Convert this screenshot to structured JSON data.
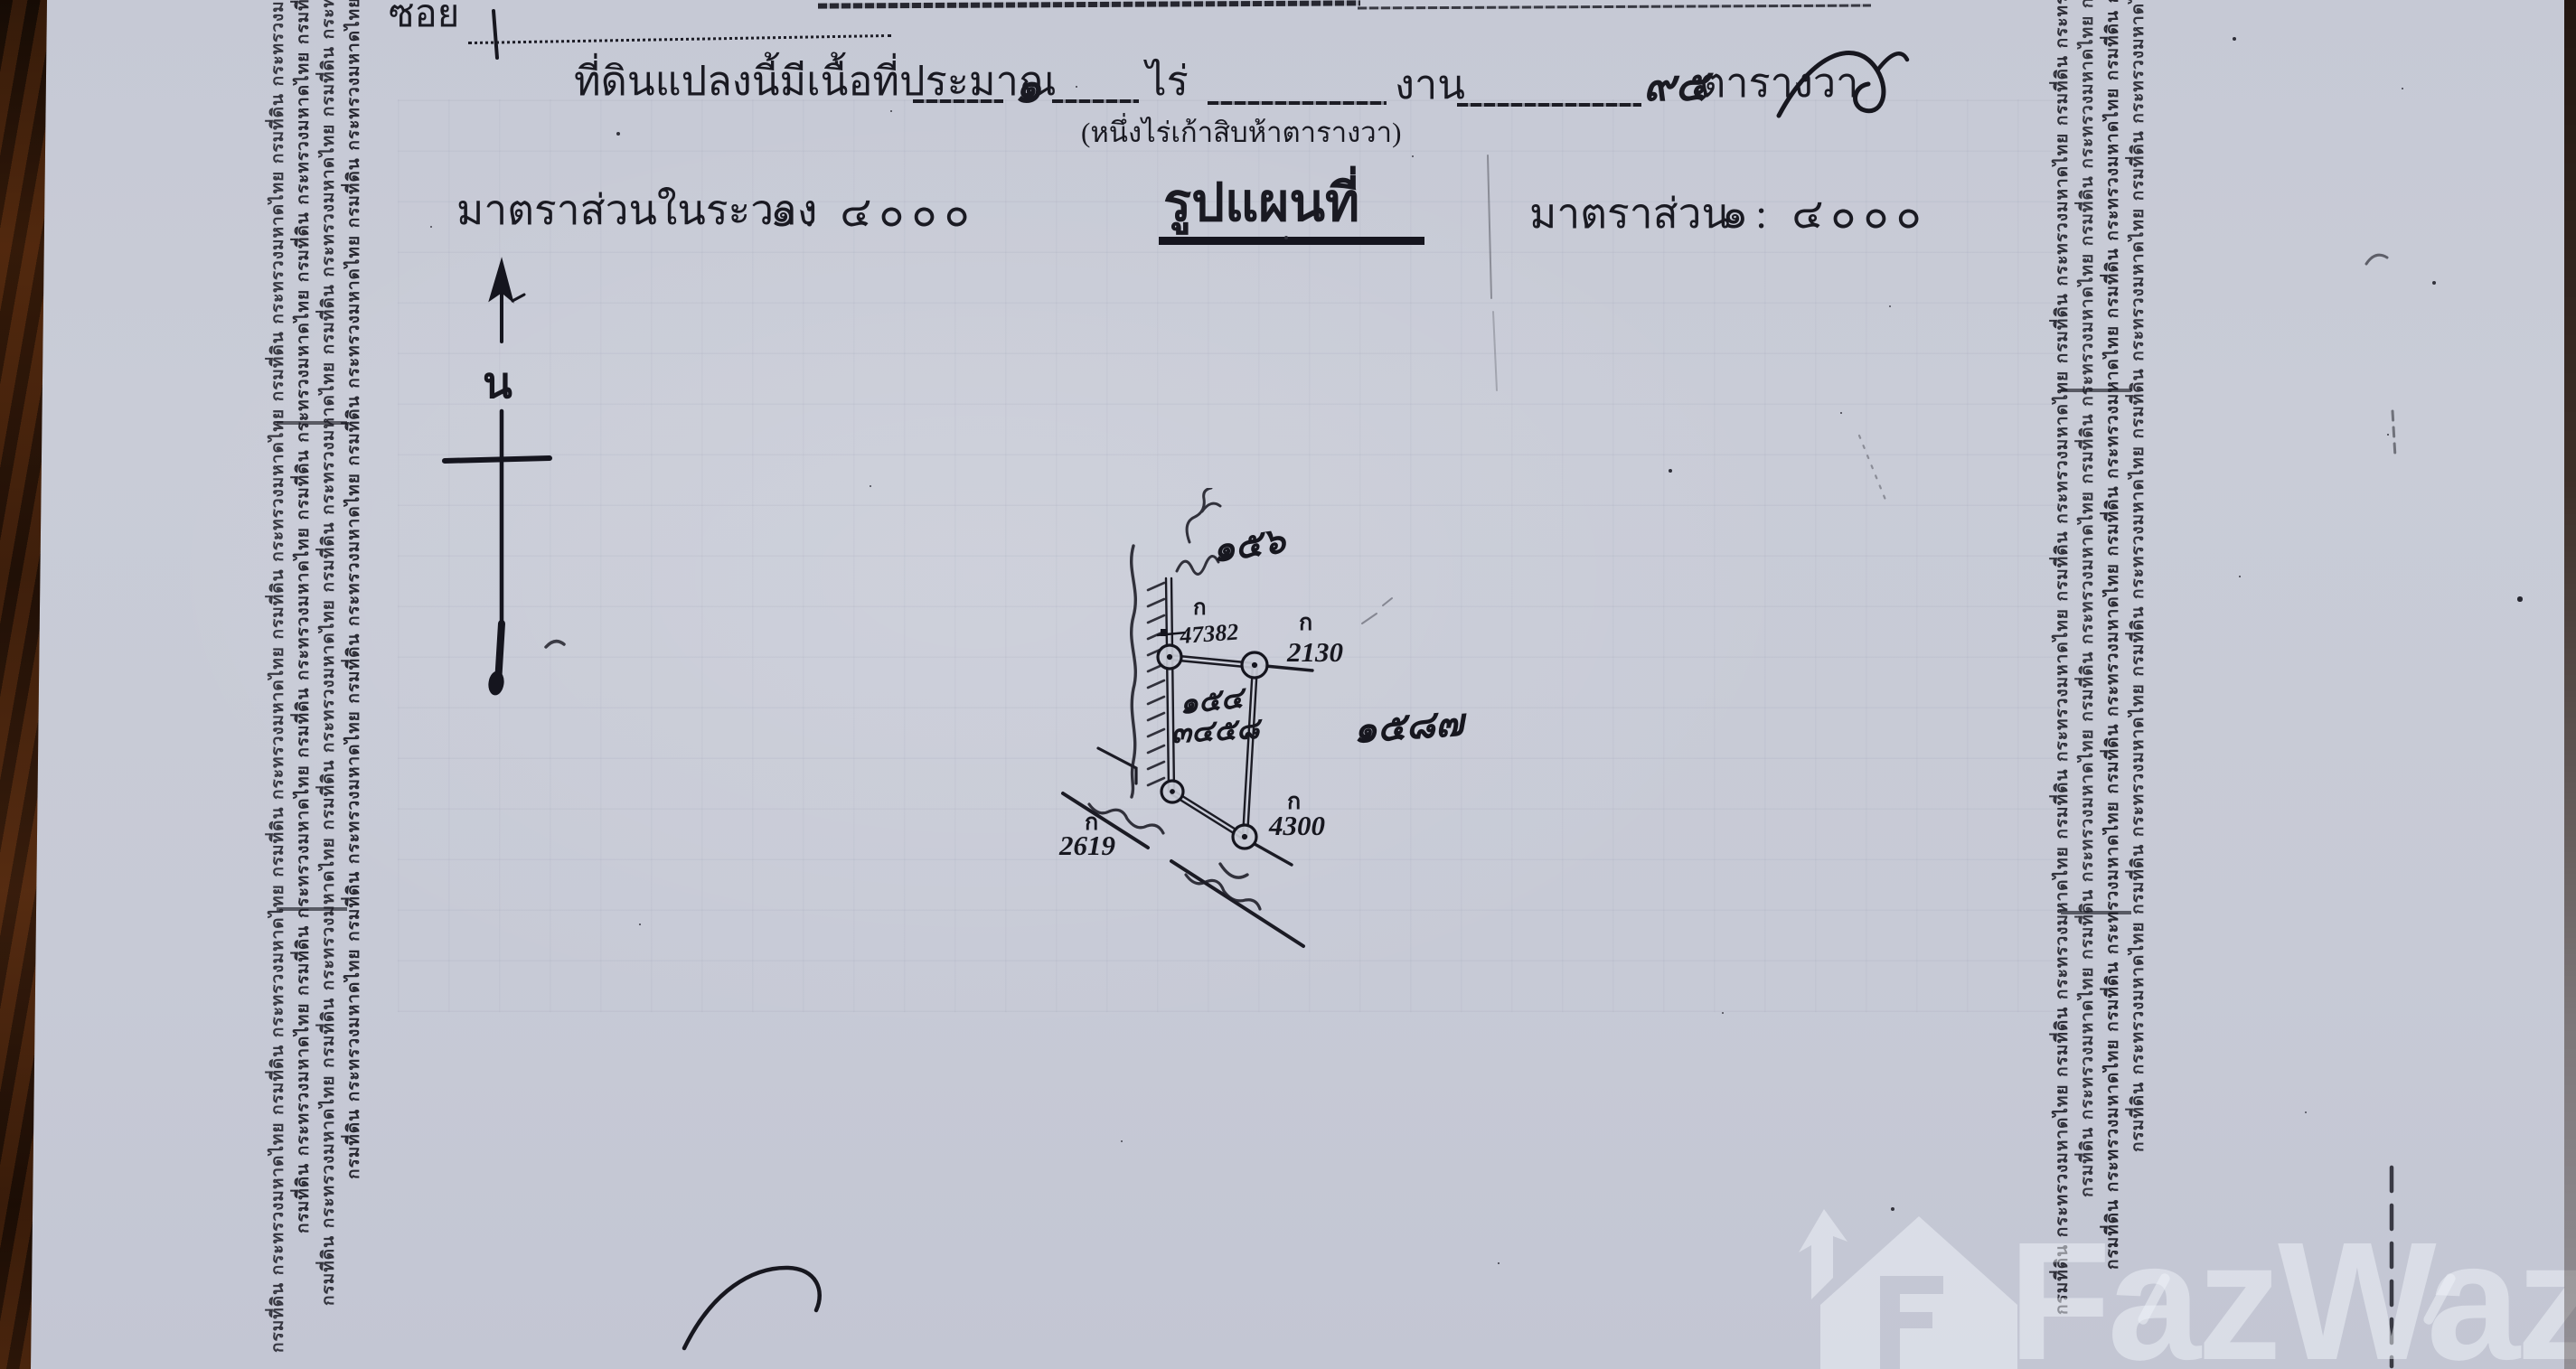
{
  "colors": {
    "paper": "#c9ccd7",
    "ink": "#1a1a22",
    "wood_edge": "#3c1f0c",
    "watermark": "rgba(240,243,250,0.5)"
  },
  "header": {
    "soi_label": "ซอย",
    "area_prefix": "ที่ดินแปลงนี้มีเนื้อที่ประมาณ",
    "rai_value": "๑",
    "rai_unit": "ไร่",
    "ngan_unit": "งาน",
    "wa_value": "๙๕",
    "wa_unit": "ตารางวา",
    "area_words": "(หนึ่งไร่เก้าสิบห้าตารางวา)",
    "scale_in_sheet_label": "มาตราส่วนในระวาง",
    "scale_in_sheet_value": "๑: ๔๐๐๐",
    "map_title": "รูปแผนที่",
    "scale_label": "มาตราส่วน",
    "scale_value": "๑: ๔๐๐๐"
  },
  "compass": {
    "north_label": "น"
  },
  "security_strip": {
    "text": "กรมที่ดิน กระทรวงมหาดไทย",
    "repeat": 9
  },
  "plot": {
    "marker_letter": "ก",
    "stones": {
      "northwest": "47382",
      "northeast": "2130",
      "southeast": "4300",
      "southwest": "2619"
    },
    "handwritten": {
      "north": "๑๕๖",
      "east": "๑๕๘๗",
      "parcel_line1": "๑๕๔",
      "parcel_line2": "๓๔๕๘"
    }
  },
  "watermark": {
    "brand": "FazWaz"
  }
}
